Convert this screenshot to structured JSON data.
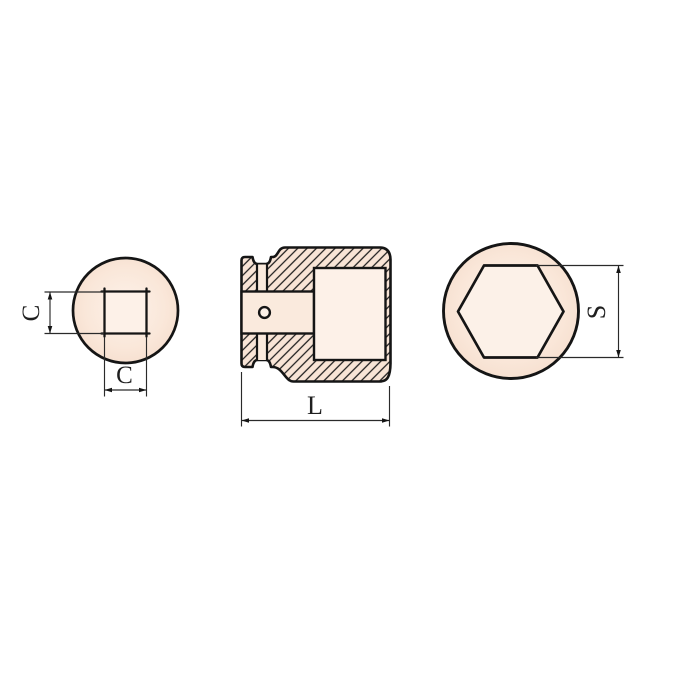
{
  "drawing": {
    "type": "technical-drawing-socket-tool",
    "views": {
      "drive_end": "square-drive-end-view",
      "section": "longitudinal-section-view",
      "socket_end": "hex-socket-end-view"
    },
    "labels": {
      "c_vertical": "C",
      "c_horizontal": "C",
      "length": "L",
      "across_flats": "S"
    },
    "colors": {
      "outline": "#151515",
      "body_fill": "#f8e4d6",
      "inner_fill": "#fdf1e8",
      "band_fill": "#faeadd",
      "dim_line": "#2a2a2a",
      "background": "#ffffff"
    }
  }
}
